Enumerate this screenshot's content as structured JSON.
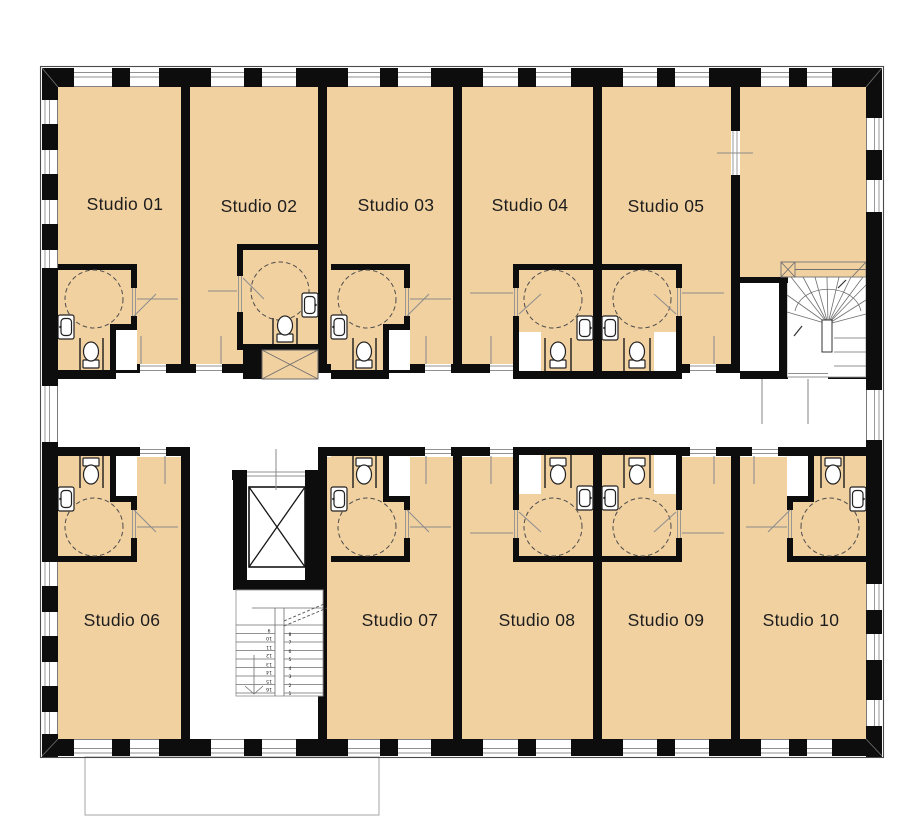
{
  "document": {
    "type": "architectural-floor-plan",
    "description": "Floor plan with ten studio apartments along a central corridor, accessible bathrooms, elevator core, central switchback stair and a winder stair"
  },
  "colors": {
    "floor_fill": "#f2d1a1",
    "wall": "#0d0d0d",
    "thin_line": "#8c8c8c",
    "background": "#ffffff"
  },
  "studios": [
    {
      "id": "01",
      "label": "Studio 01"
    },
    {
      "id": "02",
      "label": "Studio 02"
    },
    {
      "id": "03",
      "label": "Studio 03"
    },
    {
      "id": "04",
      "label": "Studio 04"
    },
    {
      "id": "05",
      "label": "Studio 05"
    },
    {
      "id": "06",
      "label": "Studio 06"
    },
    {
      "id": "07",
      "label": "Studio 07"
    },
    {
      "id": "08",
      "label": "Studio 08"
    },
    {
      "id": "09",
      "label": "Studio 09"
    },
    {
      "id": "10",
      "label": "Studio 10"
    }
  ],
  "core": {
    "left_flight": [
      "9",
      "10",
      "11",
      "12",
      "13",
      "14",
      "15",
      "16"
    ],
    "right_flight": [
      "8",
      "7",
      "6",
      "5",
      "4",
      "3",
      "2",
      "1"
    ]
  }
}
